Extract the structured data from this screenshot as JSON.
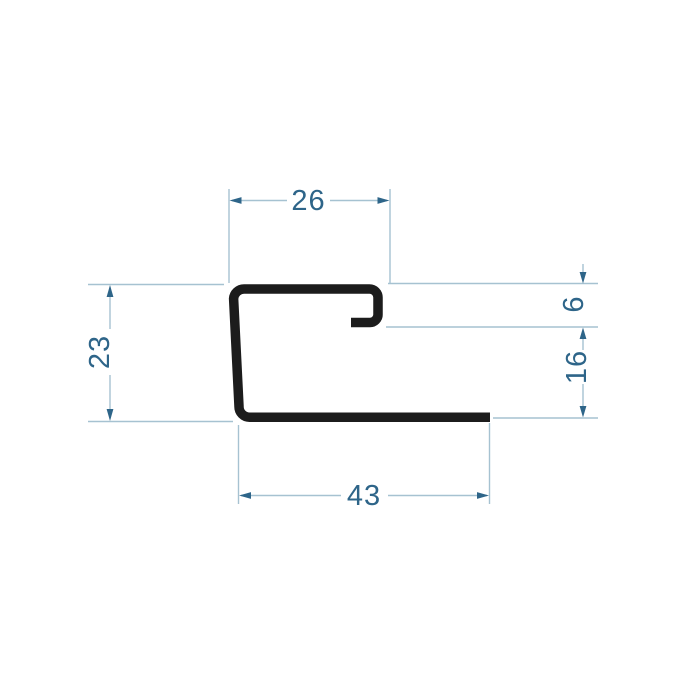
{
  "colors": {
    "background": "#ffffff",
    "profile": "#1c1c1c",
    "dim_line": "#a6c2d1",
    "dim_accent": "#2e6589"
  },
  "drawing": {
    "kind": "profile-cross-section",
    "dimensions": {
      "top_width": "26",
      "left_height": "23",
      "right_upper": "6",
      "right_lower": "16",
      "bottom_width": "43"
    }
  }
}
